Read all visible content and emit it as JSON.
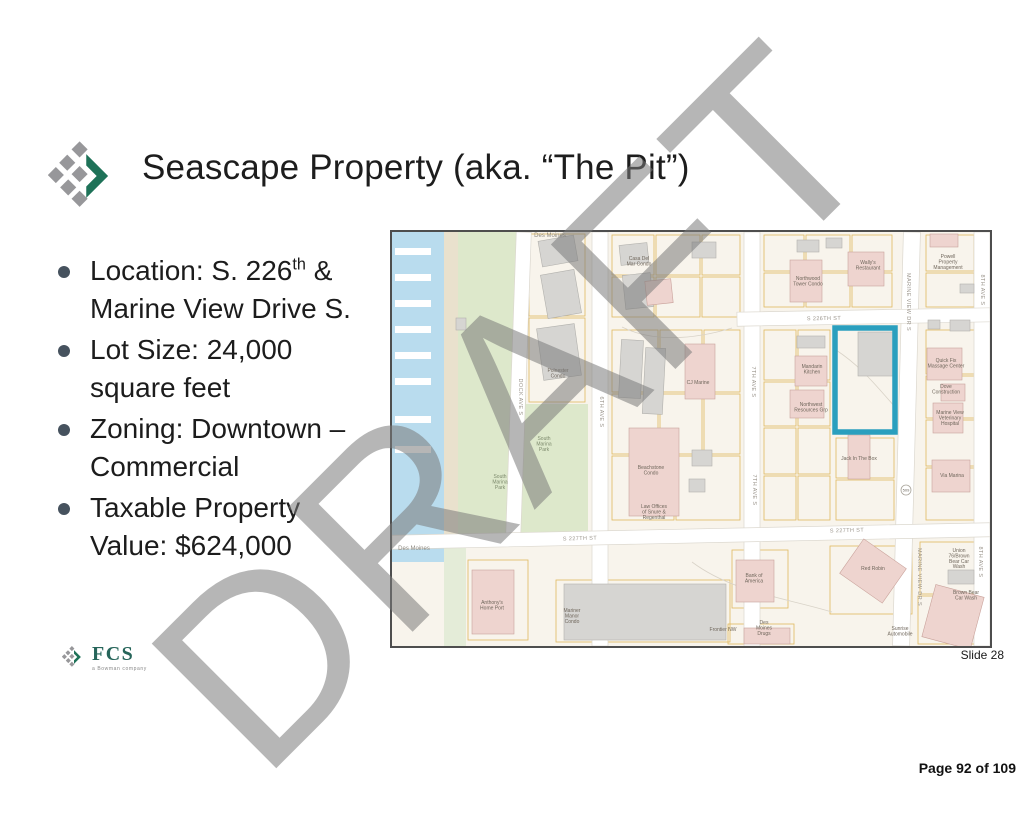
{
  "title": "Seascape Property (aka. “The Pit”)",
  "watermark": "DRAFT",
  "bullets": [
    {
      "line1_pre": "Location: S. 226",
      "line1_sup": "th",
      "line1_post": " &",
      "line2": "Marine View Drive S."
    },
    {
      "line1": "Lot Size: 24,000",
      "line2": "square feet"
    },
    {
      "line1": "Zoning: Downtown –",
      "line2": "Commercial"
    },
    {
      "line1": "Taxable Property",
      "line2": "Value: $624,000"
    }
  ],
  "footer": {
    "slide_label": "Slide 28",
    "page_label": "Page 92 of 109",
    "logo_text": "FCS",
    "logo_tagline": "a Bowman company"
  },
  "map": {
    "highlight_color": "#2a9fbe",
    "colors": {
      "bg": "#f8f4ec",
      "water": "#b9dcee",
      "beach": "#e9e1cd",
      "park": "#dde8cb",
      "park2": "#e4ecd8",
      "parcel": "#e0b95e",
      "street_edge": "#dcd8cf",
      "gray": "#d6d5d2",
      "gray_edge": "#b2b1ad",
      "pink": "#eed4cf",
      "pink_edge": "#c9a29b"
    },
    "piers": [
      16,
      42,
      68,
      94,
      120,
      146,
      184,
      214
    ],
    "parcels": [
      [
        137,
        2,
        56,
        82
      ],
      [
        137,
        86,
        56,
        84
      ],
      [
        220,
        3,
        42,
        40
      ],
      [
        220,
        45,
        42,
        40
      ],
      [
        264,
        3,
        44,
        40
      ],
      [
        310,
        3,
        38,
        40
      ],
      [
        264,
        45,
        44,
        40
      ],
      [
        310,
        45,
        38,
        40
      ],
      [
        372,
        3,
        40,
        36
      ],
      [
        372,
        41,
        40,
        34
      ],
      [
        414,
        3,
        44,
        36
      ],
      [
        414,
        41,
        44,
        34
      ],
      [
        460,
        3,
        40,
        36
      ],
      [
        460,
        41,
        40,
        34
      ],
      [
        534,
        3,
        48,
        36
      ],
      [
        534,
        41,
        48,
        34
      ],
      [
        372,
        98,
        32,
        50
      ],
      [
        372,
        150,
        32,
        44
      ],
      [
        372,
        196,
        32,
        46
      ],
      [
        372,
        244,
        32,
        44
      ],
      [
        406,
        98,
        32,
        50
      ],
      [
        406,
        150,
        32,
        44
      ],
      [
        406,
        196,
        32,
        46
      ],
      [
        406,
        244,
        32,
        44
      ],
      [
        444,
        206,
        58,
        40
      ],
      [
        444,
        248,
        58,
        40
      ],
      [
        534,
        98,
        50,
        44
      ],
      [
        534,
        144,
        50,
        42
      ],
      [
        534,
        188,
        50,
        46
      ],
      [
        534,
        236,
        50,
        52
      ],
      [
        220,
        98,
        46,
        62
      ],
      [
        268,
        98,
        42,
        62
      ],
      [
        312,
        98,
        36,
        62
      ],
      [
        220,
        162,
        46,
        60
      ],
      [
        268,
        162,
        42,
        60
      ],
      [
        312,
        162,
        36,
        60
      ],
      [
        220,
        224,
        62,
        64
      ],
      [
        284,
        224,
        64,
        64
      ],
      [
        76,
        328,
        60,
        80
      ],
      [
        164,
        348,
        174,
        62
      ],
      [
        340,
        318,
        56,
        58
      ],
      [
        336,
        392,
        66,
        20
      ],
      [
        438,
        314,
        82,
        68
      ],
      [
        528,
        310,
        60,
        52
      ],
      [
        526,
        364,
        62,
        48
      ]
    ],
    "streets": [
      {
        "x": 119,
        "y": 0,
        "w": 15,
        "h": 304,
        "r": 2
      },
      {
        "x": 200,
        "y": 0,
        "w": 16,
        "h": 414,
        "r": 0
      },
      {
        "x": 352,
        "y": 0,
        "w": 16,
        "h": 414,
        "r": 0
      },
      {
        "x": 506,
        "y": 0,
        "w": 17,
        "h": 414,
        "r": 1.5
      },
      {
        "x": 582,
        "y": 0,
        "w": 16,
        "h": 414,
        "r": 0
      },
      {
        "x": 345,
        "y": 78,
        "w": 253,
        "h": 14,
        "r": -1
      },
      {
        "x": 0,
        "y": 297,
        "w": 598,
        "h": 14,
        "r": -1.2
      }
    ],
    "contours": [
      "M444,118 C470,135 485,155 504,176",
      "M300,330 C340,360 390,365 440,380",
      "M230,95 C260,110 300,108 340,96"
    ],
    "buildings": [
      {
        "x": 148,
        "y": 6,
        "w": 36,
        "h": 26,
        "c": "g",
        "r": -10
      },
      {
        "x": 152,
        "y": 40,
        "w": 34,
        "h": 44,
        "c": "g",
        "r": -10
      },
      {
        "x": 148,
        "y": 94,
        "w": 38,
        "h": 52,
        "c": "g",
        "r": -8
      },
      {
        "x": 64,
        "y": 86,
        "w": 10,
        "h": 12,
        "c": "g",
        "r": 0
      },
      {
        "x": 228,
        "y": 12,
        "w": 28,
        "h": 20,
        "c": "g",
        "r": -6
      },
      {
        "x": 232,
        "y": 42,
        "w": 28,
        "h": 34,
        "c": "g",
        "r": -6
      },
      {
        "x": 254,
        "y": 48,
        "w": 26,
        "h": 24,
        "c": "p",
        "r": -6
      },
      {
        "x": 300,
        "y": 10,
        "w": 24,
        "h": 16,
        "c": "g",
        "r": 0
      },
      {
        "x": 405,
        "y": 8,
        "w": 22,
        "h": 12,
        "c": "g",
        "r": 0
      },
      {
        "x": 434,
        "y": 6,
        "w": 16,
        "h": 10,
        "c": "g",
        "r": 0
      },
      {
        "x": 398,
        "y": 28,
        "w": 32,
        "h": 42,
        "c": "p",
        "r": 0
      },
      {
        "x": 456,
        "y": 20,
        "w": 36,
        "h": 34,
        "c": "p",
        "r": 0
      },
      {
        "x": 538,
        "y": 2,
        "w": 28,
        "h": 13,
        "c": "p",
        "r": 0
      },
      {
        "x": 568,
        "y": 52,
        "w": 14,
        "h": 9,
        "c": "g",
        "r": 0
      },
      {
        "x": 536,
        "y": 88,
        "w": 12,
        "h": 9,
        "c": "g",
        "r": 0
      },
      {
        "x": 558,
        "y": 88,
        "w": 20,
        "h": 11,
        "c": "g",
        "r": 0
      },
      {
        "x": 228,
        "y": 108,
        "w": 22,
        "h": 58,
        "c": "g",
        "r": 3
      },
      {
        "x": 252,
        "y": 116,
        "w": 20,
        "h": 66,
        "c": "g",
        "r": 3
      },
      {
        "x": 293,
        "y": 112,
        "w": 30,
        "h": 55,
        "c": "p",
        "r": 0
      },
      {
        "x": 405,
        "y": 104,
        "w": 28,
        "h": 12,
        "c": "g",
        "r": 0
      },
      {
        "x": 403,
        "y": 124,
        "w": 32,
        "h": 30,
        "c": "p",
        "r": 0
      },
      {
        "x": 398,
        "y": 158,
        "w": 34,
        "h": 28,
        "c": "p",
        "r": 0
      },
      {
        "x": 466,
        "y": 100,
        "w": 36,
        "h": 44,
        "c": "g",
        "r": 0
      },
      {
        "x": 535,
        "y": 116,
        "w": 35,
        "h": 32,
        "c": "p",
        "r": 0
      },
      {
        "x": 549,
        "y": 152,
        "w": 24,
        "h": 17,
        "c": "p",
        "r": 0
      },
      {
        "x": 541,
        "y": 171,
        "w": 30,
        "h": 30,
        "c": "p",
        "r": 0
      },
      {
        "x": 237,
        "y": 196,
        "w": 50,
        "h": 88,
        "c": "p",
        "r": 0
      },
      {
        "x": 300,
        "y": 218,
        "w": 20,
        "h": 16,
        "c": "g",
        "r": 0
      },
      {
        "x": 297,
        "y": 247,
        "w": 16,
        "h": 13,
        "c": "g",
        "r": 0
      },
      {
        "x": 456,
        "y": 203,
        "w": 22,
        "h": 44,
        "c": "p",
        "r": 0
      },
      {
        "x": 540,
        "y": 228,
        "w": 38,
        "h": 32,
        "c": "p",
        "r": 0
      },
      {
        "x": 80,
        "y": 338,
        "w": 42,
        "h": 64,
        "c": "p",
        "r": 0
      },
      {
        "x": 172,
        "y": 352,
        "w": 162,
        "h": 56,
        "c": "g",
        "r": 0
      },
      {
        "x": 344,
        "y": 328,
        "w": 38,
        "h": 42,
        "c": "p",
        "r": 0
      },
      {
        "x": 455,
        "y": 318,
        "w": 52,
        "h": 42,
        "c": "p",
        "r": 35
      },
      {
        "x": 352,
        "y": 396,
        "w": 46,
        "h": 16,
        "c": "p",
        "r": 0
      },
      {
        "x": 556,
        "y": 338,
        "w": 26,
        "h": 14,
        "c": "g",
        "r": 0
      },
      {
        "x": 536,
        "y": 358,
        "w": 50,
        "h": 54,
        "c": "p",
        "r": 15
      }
    ],
    "highlight": {
      "x": 443,
      "y": 96,
      "w": 60,
      "h": 104
    },
    "shield": {
      "text": "509",
      "x": 514,
      "y": 258
    },
    "street_labels": [
      {
        "t": "S 226TH ST",
        "x": 432,
        "y": 88,
        "r": -1
      },
      {
        "t": "S 227TH ST",
        "x": 188,
        "y": 308,
        "r": -1.5
      },
      {
        "t": "S 227TH ST",
        "x": 455,
        "y": 300,
        "r": -1.5
      },
      {
        "t": "DOCK AVE S",
        "x": 127,
        "y": 165,
        "r": 90
      },
      {
        "t": "6TH AVE S",
        "x": 208,
        "y": 180,
        "r": 90
      },
      {
        "t": "7TH AVE S",
        "x": 360,
        "y": 150,
        "r": 90
      },
      {
        "t": "7TH AVE S",
        "x": 361,
        "y": 258,
        "r": 90
      },
      {
        "t": "MARINE VIEW DR S",
        "x": 515,
        "y": 70,
        "r": 90
      },
      {
        "t": "MARINE VIEW DR S",
        "x": 526,
        "y": 345,
        "r": 90
      },
      {
        "t": "8TH AVE S",
        "x": 589,
        "y": 58,
        "r": 90
      },
      {
        "t": "8TH AVE S",
        "x": 587,
        "y": 330,
        "r": 90
      }
    ],
    "place_labels": [
      {
        "t": "Des Moines",
        "x": 158,
        "y": 5,
        "s": 6,
        "c": "#8e8a82"
      },
      {
        "t": "Casa Del\nMar Condo",
        "x": 247,
        "y": 28
      },
      {
        "t": "Wally's\nRestaurant",
        "x": 476,
        "y": 32
      },
      {
        "t": "Powell\nProperty\nManagement",
        "x": 556,
        "y": 26
      },
      {
        "t": "Northwood\nTower Condo",
        "x": 416,
        "y": 48
      },
      {
        "t": "Polnester\nCondo",
        "x": 166,
        "y": 140
      },
      {
        "t": "CJ Marine",
        "x": 306,
        "y": 152
      },
      {
        "t": "Mandarin\nKitchen",
        "x": 420,
        "y": 136
      },
      {
        "t": "Northwest\nResources Grp",
        "x": 419,
        "y": 174
      },
      {
        "t": "South\nMarina\nPark",
        "x": 152,
        "y": 208,
        "c": "#7d8a6d"
      },
      {
        "t": "South\nMarina\nPark",
        "x": 108,
        "y": 246,
        "c": "#7d8a6d"
      },
      {
        "t": "Beachstone\nCondo",
        "x": 259,
        "y": 237
      },
      {
        "t": "Law Offices\nof Snure &\nRegenthal",
        "x": 262,
        "y": 276
      },
      {
        "t": "Jack In The Box",
        "x": 467,
        "y": 228
      },
      {
        "t": "Via Marina",
        "x": 560,
        "y": 245
      },
      {
        "t": "Quick Fix\nMassage Center",
        "x": 554,
        "y": 130
      },
      {
        "t": "Dove\nConstruction",
        "x": 554,
        "y": 156
      },
      {
        "t": "Marine View\nVeterinary\nHospital",
        "x": 558,
        "y": 182
      },
      {
        "t": "Des Moines",
        "x": 22,
        "y": 318,
        "s": 6,
        "c": "#8e8a82"
      },
      {
        "t": "Anthony's\nHome Port",
        "x": 100,
        "y": 372
      },
      {
        "t": "Mariner\nManor\nCondo",
        "x": 180,
        "y": 380
      },
      {
        "t": "Bank of\nAmerica",
        "x": 362,
        "y": 345
      },
      {
        "t": "Red Robin",
        "x": 481,
        "y": 338
      },
      {
        "t": "Frontier NW",
        "x": 331,
        "y": 399
      },
      {
        "t": "Des\nMoines\nDrugs",
        "x": 372,
        "y": 392
      },
      {
        "t": "Sunrise\nAutomobile",
        "x": 508,
        "y": 398
      },
      {
        "t": "Union\n76/Brown\nBear Car\nWash",
        "x": 567,
        "y": 320
      },
      {
        "t": "Brown Bear\nCar Wash",
        "x": 574,
        "y": 362
      }
    ]
  }
}
